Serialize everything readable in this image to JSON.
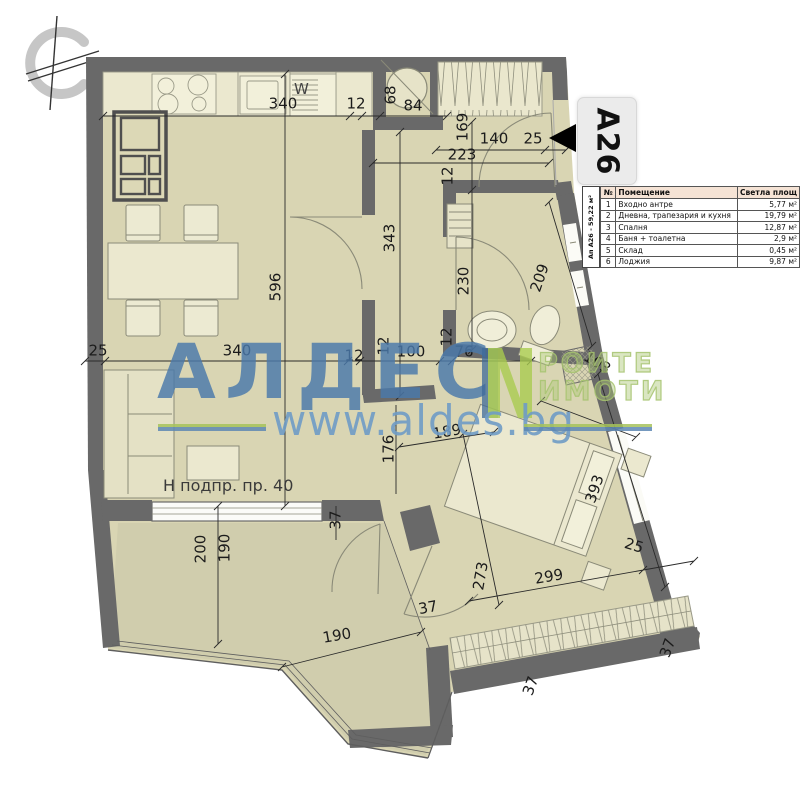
{
  "badge": {
    "label": "А26"
  },
  "table": {
    "unit_label": "Ап А26 - 59,22 м²",
    "headers": [
      "№",
      "Помещение",
      "Светла площ"
    ],
    "rows": [
      [
        "1",
        "Входно антре",
        "5,77 м²"
      ],
      [
        "2",
        "Дневна, трапезария и кухня",
        "19,79 м²"
      ],
      [
        "3",
        "Спалня",
        "12,87 м²"
      ],
      [
        "4",
        "Баня + тоалетна",
        "2,9 м²"
      ],
      [
        "5",
        "Склад",
        "0,45 м²"
      ],
      [
        "6",
        "Лоджия",
        "9,87 м²"
      ]
    ]
  },
  "watermark": {
    "brand": "АЛДЕС",
    "logo_letter": "N",
    "tagline_line1": "РОИТЕ",
    "tagline_line2": "ИМОТИ",
    "url": "www.aldes.bg",
    "brand_color": "#4a79ab",
    "green_color": "#a6c35c"
  },
  "plan": {
    "window_note": "Н подпр. пр. 40",
    "appliance_label": "W",
    "colors": {
      "wall": "#696969",
      "floor": "#d9d5b3",
      "loggia": "#d0cdad",
      "table_header": "#f5e3d5"
    },
    "dimensions": [
      {
        "label": "340",
        "x": 283,
        "y": 104,
        "r": 0
      },
      {
        "label": "12",
        "x": 356,
        "y": 104,
        "r": 0
      },
      {
        "label": "68",
        "x": 391,
        "y": 95,
        "r": -90
      },
      {
        "label": "84",
        "x": 413,
        "y": 106,
        "r": 0
      },
      {
        "label": "140",
        "x": 494,
        "y": 139,
        "r": 0
      },
      {
        "label": "25",
        "x": 533,
        "y": 139,
        "r": 0
      },
      {
        "label": "169",
        "x": 463,
        "y": 127,
        "r": -90
      },
      {
        "label": "223",
        "x": 462,
        "y": 155,
        "r": 0
      },
      {
        "label": "12",
        "x": 448,
        "y": 176,
        "r": -90
      },
      {
        "label": "596",
        "x": 276,
        "y": 287,
        "r": -90
      },
      {
        "label": "343",
        "x": 390,
        "y": 238,
        "r": -90
      },
      {
        "label": "230",
        "x": 464,
        "y": 281,
        "r": -90
      },
      {
        "label": "209",
        "x": 540,
        "y": 278,
        "r": -71
      },
      {
        "label": "12",
        "x": 447,
        "y": 337,
        "r": -90
      },
      {
        "label": "25",
        "x": 98,
        "y": 351,
        "r": 0
      },
      {
        "label": "340",
        "x": 237,
        "y": 351,
        "r": 0
      },
      {
        "label": "12",
        "x": 354,
        "y": 356,
        "r": 0
      },
      {
        "label": "12",
        "x": 384,
        "y": 346,
        "r": -90
      },
      {
        "label": "100",
        "x": 411,
        "y": 352,
        "r": 0
      },
      {
        "label": "76",
        "x": 464,
        "y": 352,
        "r": 0
      },
      {
        "label": "103",
        "x": 597,
        "y": 363,
        "r": 32
      },
      {
        "label": "176",
        "x": 389,
        "y": 449,
        "r": -90
      },
      {
        "label": "189",
        "x": 447,
        "y": 432,
        "r": -10
      },
      {
        "label": "37",
        "x": 336,
        "y": 520,
        "r": -90
      },
      {
        "label": "200",
        "x": 201,
        "y": 549,
        "r": -90
      },
      {
        "label": "190",
        "x": 225,
        "y": 548,
        "r": -90
      },
      {
        "label": "393",
        "x": 595,
        "y": 489,
        "r": -71
      },
      {
        "label": "25",
        "x": 634,
        "y": 546,
        "r": 17
      },
      {
        "label": "273",
        "x": 481,
        "y": 576,
        "r": -80
      },
      {
        "label": "299",
        "x": 549,
        "y": 577,
        "r": -10
      },
      {
        "label": "37",
        "x": 428,
        "y": 608,
        "r": -10
      },
      {
        "label": "190",
        "x": 337,
        "y": 636,
        "r": -10
      },
      {
        "label": "37",
        "x": 531,
        "y": 686,
        "r": -70
      },
      {
        "label": "37",
        "x": 668,
        "y": 648,
        "r": -70
      }
    ]
  }
}
